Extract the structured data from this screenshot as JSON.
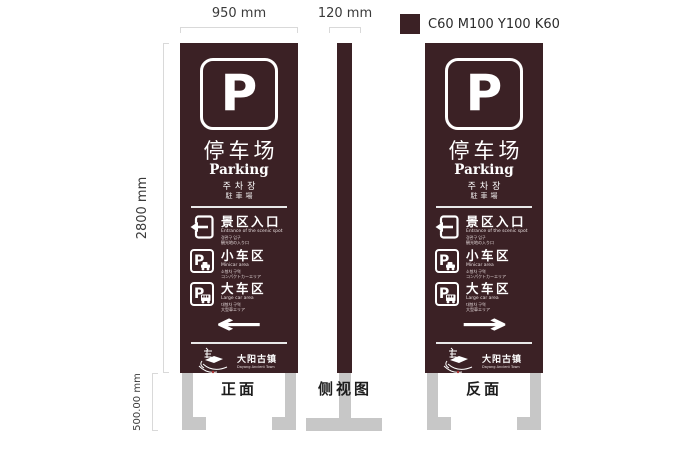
{
  "dimensions": {
    "front_width": "950 mm",
    "side_width": "120 mm",
    "total_height": "2800 mm",
    "base_height": "500.00 mm"
  },
  "color_spec": {
    "label": "C60 M100 Y100 K60",
    "panel_hex": "#3b2125",
    "base_hex": "#c7c7c7",
    "dimension_line_hex": "#d9d9d9"
  },
  "views": {
    "front_label": "正面",
    "side_label": "侧视图",
    "back_label": "反面"
  },
  "sign": {
    "p_badge": "P",
    "title_cn": "停车场",
    "title_en": "Parking",
    "title_kr": "주차장",
    "title_jp": "駐車場",
    "rows": [
      {
        "icon": "entrance-arrow-icon",
        "title": "景区入口",
        "sub_en": "Entrance of the scenic spot",
        "sub_kr": "경관구 입구",
        "sub_jp": "観光地の入り口"
      },
      {
        "icon": "parking-car-icon",
        "title": "小车区",
        "sub_en": "Minicar area",
        "sub_kr": "소형차 구역",
        "sub_jp": "コンパクトカーエリア"
      },
      {
        "icon": "parking-bus-icon",
        "title": "大车区",
        "sub_en": "Large car area",
        "sub_kr": "대형차 구역",
        "sub_jp": "大型車エリア"
      }
    ],
    "front_arrow": "←",
    "back_arrow": "→",
    "logo_icon": "ancient-town-logo-icon",
    "logo_cn": "大阳古镇",
    "logo_en": "Dayang Ancient Town"
  }
}
